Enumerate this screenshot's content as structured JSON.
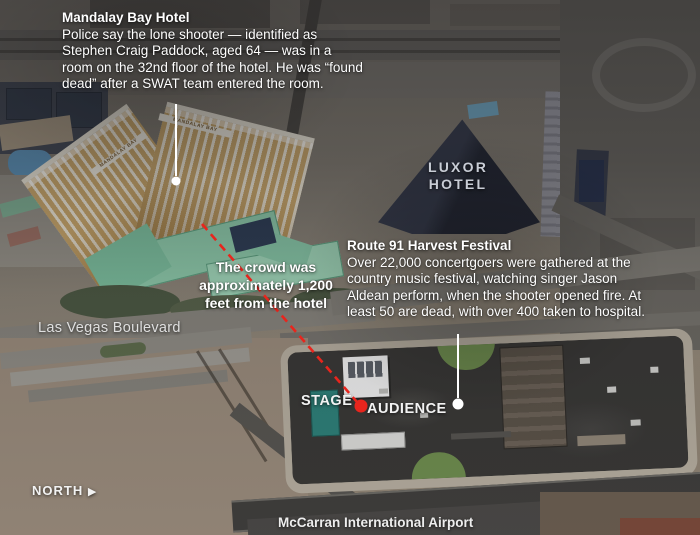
{
  "graphic": {
    "annotations": {
      "mandalay": {
        "title": "Mandalay Bay Hotel",
        "body": "Police say the lone shooter — identified as Stephen Craig Paddock, aged 64 — was in a room on the 32nd floor of the hotel. He was “found dead” after a SWAT team entered the room."
      },
      "festival": {
        "title": "Route 91 Harvest Festival",
        "body": "Over 22,000 concertgoers were gathered at the country music festival, watching singer Jason Aldean perform, when the shooter opened fire. At least 50 are dead, with over 400 taken to hospital."
      },
      "distance": "The crowd was approximately 1,200 feet from the hotel"
    },
    "map_labels": {
      "luxor_line1": "LUXOR",
      "luxor_line2": "HOTEL",
      "boulevard": "Las Vegas Boulevard",
      "stage": "STAGE",
      "audience": "AUDIENCE",
      "north": "NORTH",
      "airport": "McCarran International Airport",
      "mandalay_roof": "MANDALAY BAY"
    },
    "icons": {
      "north_arrow": "▶"
    },
    "colors": {
      "callout_red": "#e8251d",
      "callout_white": "#ffffff",
      "text": "#ffffff"
    }
  }
}
